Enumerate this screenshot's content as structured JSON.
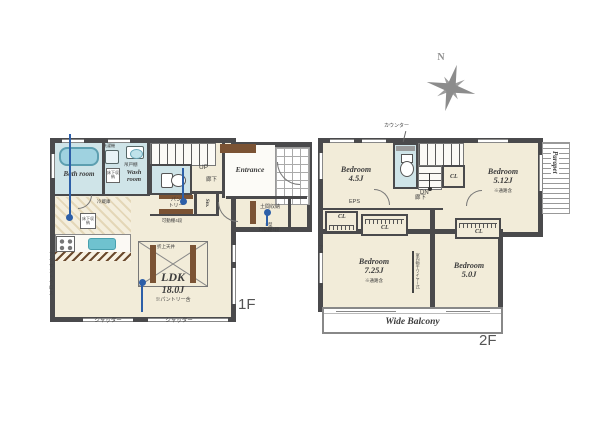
{
  "colors": {
    "wall": "#4a4a4c",
    "floor": "#f2ecd9",
    "wet_room": "#cfe4e8",
    "wood": "#7b5334",
    "water": "#6fc2cf",
    "pin": "#2d5fa8",
    "compass": "#8f8f8f"
  },
  "compass": {
    "north_label": "N"
  },
  "floor1": {
    "floor_label": "1F",
    "bath_room": "Bath room",
    "wash_room": "Wash room",
    "washer": "洗濯機",
    "hanging_cupboard": "吊戸棚",
    "underfloor_storage": "床下収納",
    "underfloor_storage_kitchen": "床下収納",
    "fridge": "冷蔵庫",
    "stairs_up": "UP",
    "hallway": "廊下",
    "entrance": "Entrance",
    "doma_storage": "土間収納",
    "doma_shelf_note_line1": "L型",
    "doma_shelf_note_line2": "可動棚4段",
    "pantry_line1": "パン",
    "pantry_line2": "トリー",
    "pantry_shelf_note": "可動棚4段",
    "storage_abbr": "Sto.",
    "ldk_name": "LDK",
    "ldk_size": "18.0J",
    "ldk_note": "※パントリー含",
    "raised_ceiling": "折上天井",
    "accent_cloth": "アクセントクロス",
    "shutters": [
      "シャッター",
      "シャッター"
    ]
  },
  "floor2": {
    "floor_label": "2F",
    "counter": "カウンター",
    "stairs_down": "DN",
    "hallway": "廊下",
    "eps": "EPS",
    "closet_labels": [
      "CL",
      "CL",
      "CL",
      "CL"
    ],
    "bedrooms": [
      {
        "name": "Bedroom",
        "size": "4.5J",
        "note": ""
      },
      {
        "name": "Bedroom",
        "size": "5.12J",
        "note": "※通路含"
      },
      {
        "name": "Bedroom",
        "size": "7.25J",
        "note": "※通路含"
      },
      {
        "name": "Bedroom",
        "size": "5.0J",
        "note": ""
      }
    ],
    "parapet": "Parapet",
    "balcony": "Wide Balcony",
    "accent_cloth": "アクセントクロス",
    "indoor_drying": "室内物干ワイヤー式"
  }
}
